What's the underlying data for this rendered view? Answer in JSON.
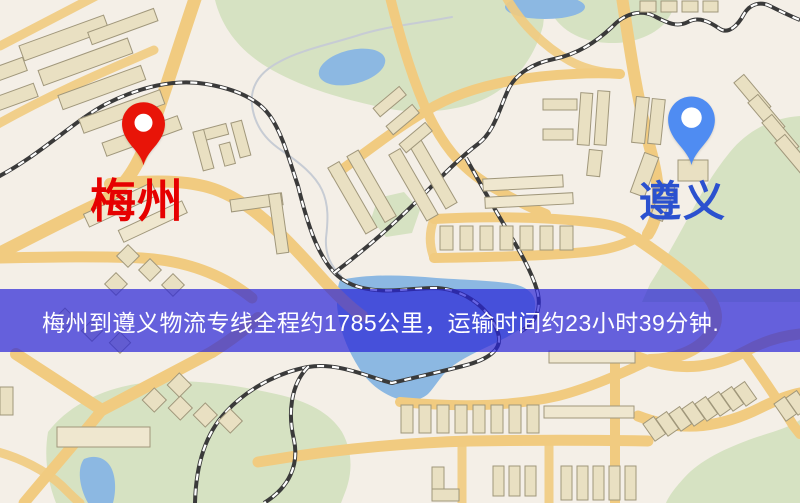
{
  "banner": {
    "text": "梅州到遵义物流专线全程约1785公里，运输时间约23小时39分钟."
  },
  "markers": {
    "origin": {
      "label": "梅州"
    },
    "destination": {
      "label": "遵义"
    }
  },
  "theme": {
    "banner-bg": "rgba(40,35,215,0.70)",
    "banner-text": "#ffffff",
    "origin-pin": "#e81408",
    "origin-label": "#e60000",
    "dest-pin": "#4f8cf2",
    "dest-label": "#2b51cf",
    "map-bg": "#f4efe7",
    "road": "#f1cb80",
    "park": "#d6e2c2",
    "water": "#8cb8e2",
    "rail": "#3a3a3a",
    "building": "#e9e0c2",
    "building-edge": "#a0977b"
  }
}
